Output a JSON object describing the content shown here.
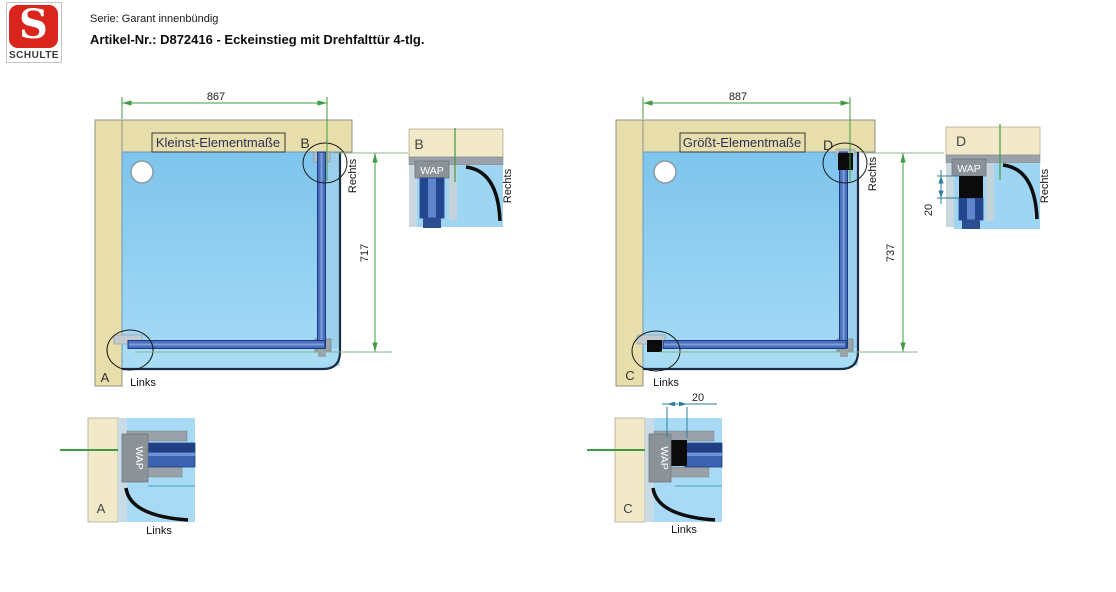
{
  "header": {
    "logo_s": "S",
    "logo_name": "SCHULTE",
    "series": "Serie: Garant innenbündig",
    "article": "Artikel-Nr.: D872416 - Eckeinstieg mit Drehfalttür 4-tlg."
  },
  "left": {
    "title": "Kleinst-Elementmaße",
    "width": "867",
    "height": "717",
    "label_top": "B",
    "label_bottom": "A",
    "links": "Links",
    "rechts": "Rechts"
  },
  "right": {
    "title": "Größt-Elementmaße",
    "width": "887",
    "height": "737",
    "label_top": "D",
    "label_bottom": "C",
    "links": "Links",
    "rechts": "Rechts"
  },
  "detail_a": {
    "label": "A",
    "wap": "WAP",
    "side": "Links"
  },
  "detail_b": {
    "label": "B",
    "wap": "WAP",
    "side": "Rechts"
  },
  "detail_c": {
    "label": "C",
    "wap": "WAP",
    "side": "Links",
    "offset": "20"
  },
  "detail_d": {
    "label": "D",
    "wap": "WAP",
    "side": "Rechts",
    "offset": "20"
  },
  "colors": {
    "brand_red": "#da251d",
    "wall_beige": "#e7deac",
    "detail_beige": "#f2e9c9",
    "tray_blue": "#8ccdf2",
    "profile_blue": "#3c62b2",
    "profile_dark_blue": "#1c3a7e",
    "wall_profile_gray": "#9aa1a9",
    "dimension_green": "#3f9b3f",
    "detail_dimension_teal": "#2e7d9a",
    "swing_arc_black": "#0d0d0d"
  }
}
